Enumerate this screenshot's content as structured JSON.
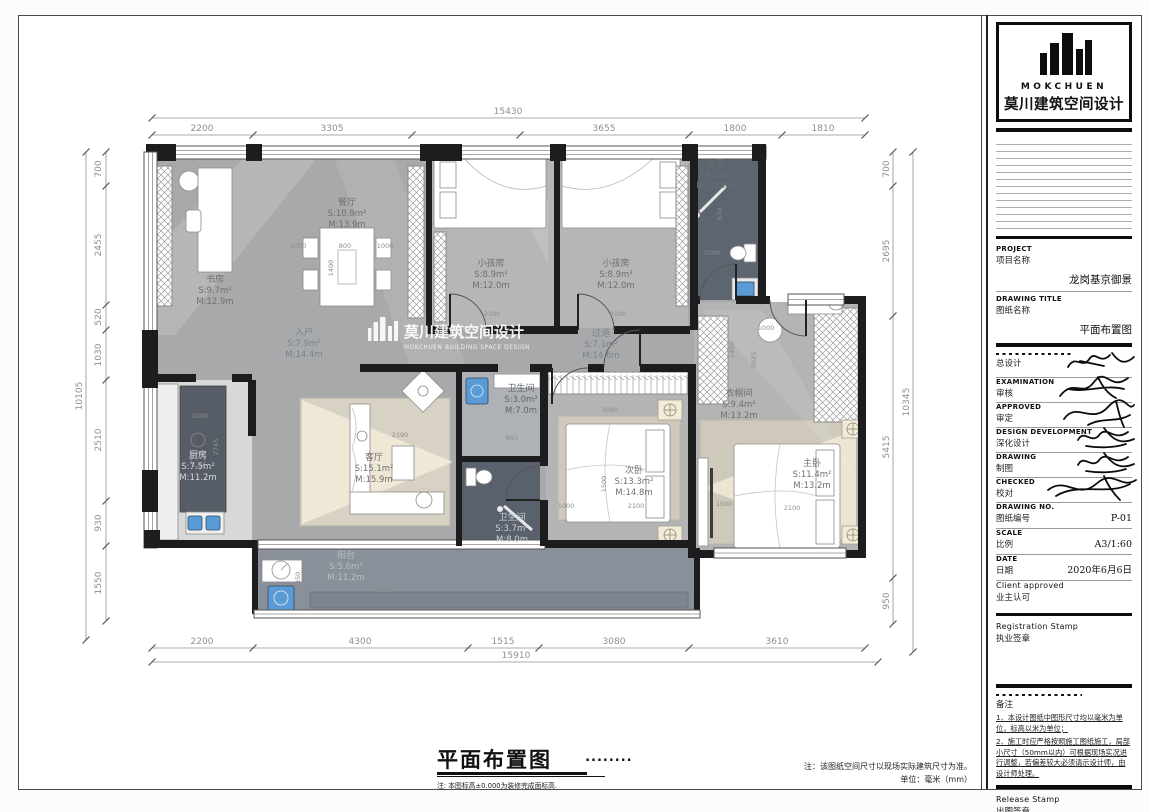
{
  "title_block": {
    "logo": {
      "brand_en": "MOKCHUEN",
      "brand_cn": "莫川建筑空间设计"
    },
    "project": {
      "label_en": "PROJECT",
      "label_cn": "项目名称",
      "value": "龙岗基京御景"
    },
    "drawing_title": {
      "label_en": "DRAWING TITLE",
      "label_cn": "图纸名称",
      "value": "平面布置图"
    },
    "sign_rows": [
      {
        "label_en": "",
        "label_cn": "总设计"
      },
      {
        "label_en": "EXAMINATION",
        "label_cn": "审核"
      },
      {
        "label_en": "APPROVED",
        "label_cn": "审定"
      },
      {
        "label_en": "DESIGN DEVELOPMENT",
        "label_cn": "深化设计"
      },
      {
        "label_en": "DRAWING",
        "label_cn": "制图"
      },
      {
        "label_en": "CHECKED",
        "label_cn": "校对"
      }
    ],
    "drawing_no": {
      "label_en": "DRAWING NO.",
      "label_cn": "图纸编号",
      "value": "P-01"
    },
    "scale": {
      "label_en": "SCALE",
      "label_cn": "比例",
      "value": "A3/1:60"
    },
    "date": {
      "label_en": "DATE",
      "label_cn": "日期",
      "value": "2020年6月6日"
    },
    "client": {
      "label_en": "Client approved",
      "label_cn": "业主认可"
    },
    "registration": {
      "label_en": "Registration Stamp",
      "label_cn": "执业签章"
    },
    "remarks_title": "备注",
    "remarks": [
      "1、本设计图纸中图形尺寸均以毫米为单位，标高以米为单位；",
      "2、施工时应严格按照施工图纸施工，局部小尺寸（50mm以内）可根据现场实况进行调整，若偏差较大必须请示设计师，由设计师处理。"
    ],
    "release": {
      "label_en": "Release Stamp",
      "label_cn": "出图签章"
    }
  },
  "sheet": {
    "title": "平面布置图",
    "dots": "........",
    "subnote": "注: 本图标高±0.000为装修完成面标高.",
    "right_note_1": "注：该图纸空间尺寸以现场实际建筑尺寸为准。",
    "right_note_2": "单位：毫米（mm）"
  },
  "watermark": {
    "cn": "莫川建筑空间设计",
    "en": "MOKCHUEN BUILDING SPACE DESIGN"
  },
  "rooms": {
    "study": {
      "name": "书房",
      "s": "S:9.7m²",
      "m": "M:12.9m"
    },
    "dining": {
      "name": "餐厅",
      "s": "S:10.9m²",
      "m": "M:13.9m"
    },
    "entry": {
      "name": "入户",
      "s": "S:7.9m²",
      "m": "M:14.4m"
    },
    "kids1": {
      "name": "小孩房",
      "s": "S:8.9m²",
      "m": "M:12.0m"
    },
    "kids2": {
      "name": "小孩房",
      "s": "S:8.9m²",
      "m": "M:12.0m"
    },
    "masterbath": {
      "name": "主卫",
      "s": "S:6.1m²",
      "m": "M:10.3m"
    },
    "hallway": {
      "name": "过道",
      "s": "S:7.1m²",
      "m": "M:14.6m"
    },
    "kitchen": {
      "name": "厨房",
      "s": "S:7.5m²",
      "m": "M:11.2m"
    },
    "living": {
      "name": "客厅",
      "s": "S:15.1m²",
      "m": "M:15.9m"
    },
    "bath1": {
      "name": "卫生间",
      "s": "S:3.0m²",
      "m": "M:7.0m"
    },
    "bath2": {
      "name": "卫生间",
      "s": "S:3.7m²",
      "m": "M:8.0m"
    },
    "bedroom2": {
      "name": "次卧",
      "s": "S:13.3m²",
      "m": "M:14.8m"
    },
    "closet": {
      "name": "衣帽间",
      "s": "S:9.4m²",
      "m": "M:13.2m"
    },
    "master": {
      "name": "主卧",
      "s": "S:11.4m²",
      "m": "M:13.2m"
    },
    "balcony": {
      "name": "阳台",
      "s": "S:5.6m²",
      "m": "M:11.2m"
    }
  },
  "dimensions": {
    "top": {
      "total": "15430",
      "segments": [
        "2200",
        "3305",
        "3655",
        "1800",
        "1810"
      ]
    },
    "bottom": {
      "total": "15910",
      "segments": [
        "2200",
        "4300",
        "1515",
        "3080",
        "3610"
      ]
    },
    "left": {
      "total": "10105",
      "segments": [
        "700",
        "2455",
        "520",
        "1030",
        "2510",
        "930",
        "1550"
      ]
    },
    "right": {
      "total": "10345",
      "segments": [
        "700",
        "2695",
        "5415",
        "950"
      ]
    }
  },
  "plan_annotations": [
    {
      "v": "2100",
      "x": 492,
      "y": 316,
      "r": 0
    },
    {
      "v": "2100",
      "x": 618,
      "y": 316,
      "r": 0
    },
    {
      "v": "1000",
      "x": 298,
      "y": 248,
      "r": 0
    },
    {
      "v": "800",
      "x": 345,
      "y": 248,
      "r": 0
    },
    {
      "v": "1000",
      "x": 385,
      "y": 248,
      "r": 0
    },
    {
      "v": "1400",
      "x": 333,
      "y": 268,
      "r": 90
    },
    {
      "v": "1000",
      "x": 200,
      "y": 418,
      "r": 0
    },
    {
      "v": "2745",
      "x": 218,
      "y": 447,
      "r": 90
    },
    {
      "v": "2190",
      "x": 400,
      "y": 437,
      "r": 0
    },
    {
      "v": "995",
      "x": 512,
      "y": 440,
      "r": 0
    },
    {
      "v": "3080",
      "x": 610,
      "y": 412,
      "r": 0
    },
    {
      "v": "1500",
      "x": 606,
      "y": 484,
      "r": 90
    },
    {
      "v": "2100",
      "x": 636,
      "y": 508,
      "r": 0
    },
    {
      "v": "1000",
      "x": 566,
      "y": 508,
      "r": 0
    },
    {
      "v": "2025",
      "x": 756,
      "y": 360,
      "r": 90
    },
    {
      "v": "1400",
      "x": 734,
      "y": 350,
      "r": 90
    },
    {
      "v": "1000",
      "x": 766,
      "y": 330,
      "r": 0
    },
    {
      "v": "1500",
      "x": 724,
      "y": 506,
      "r": 0
    },
    {
      "v": "2100",
      "x": 792,
      "y": 510,
      "r": 0
    },
    {
      "v": "3535",
      "x": 384,
      "y": 592,
      "r": 0
    },
    {
      "v": "1350",
      "x": 300,
      "y": 580,
      "r": 90
    },
    {
      "v": "670",
      "x": 722,
      "y": 214,
      "r": 90
    },
    {
      "v": "1000",
      "x": 712,
      "y": 255,
      "r": 0
    }
  ],
  "colors": {
    "wall": "#1d1d1f",
    "floor_main": "#a7a9aa",
    "floor_room": "#b5b6b5",
    "floor_dark": "#5d6571",
    "floor_balcony": "#8a909a",
    "rug": "#d4cec1",
    "light_cone": "#f5eedc",
    "appliance_blue": "#5b9bd5"
  }
}
